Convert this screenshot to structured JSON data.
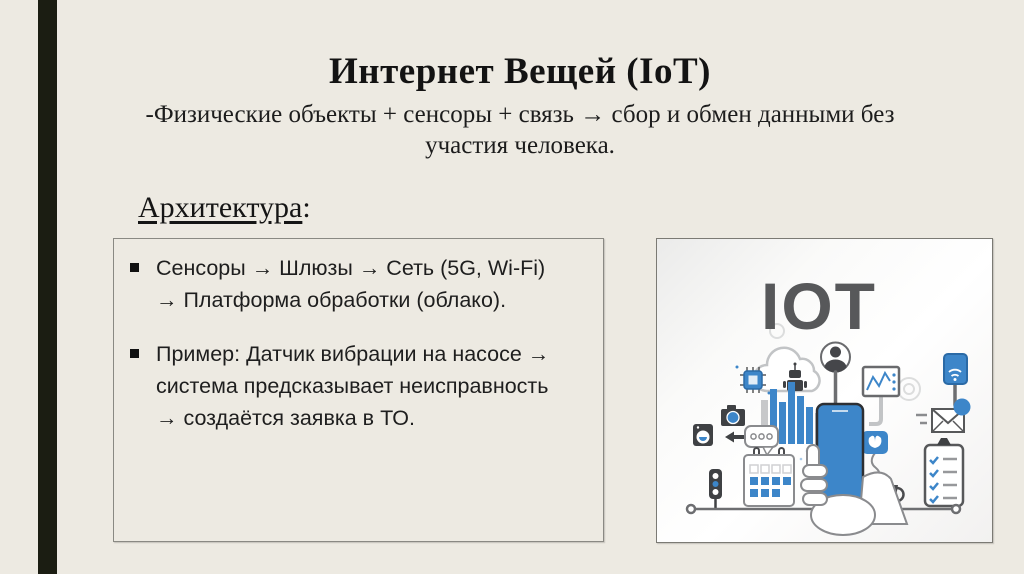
{
  "slide": {
    "title": "Интернет Вещей (IoT)",
    "subtitle_lines": [
      "-Физические объекты + сенсоры + связь → сбор и обмен данными без",
      "участия человека."
    ],
    "section_heading": {
      "word": "Архитектура",
      "colon": ":"
    },
    "bullets": [
      "Сенсоры → Шлюзы → Сеть (5G, Wi-Fi) → Платформа обработки (облако).",
      "Пример: Датчик вибрации на насосе → система предсказывает неисправность → создаётся заявка в ТО."
    ],
    "illustration": {
      "label": "IOT",
      "icons": [
        "chip-icon",
        "cloud-icon",
        "robot-icon",
        "person-avatar-icon",
        "chart-monitor-icon",
        "tablet-wifi-icon",
        "camera-icon",
        "washing-machine-icon",
        "bar-chart-icon",
        "speech-bubble-icon",
        "arrow-left-icon",
        "traffic-light-icon",
        "calendar-icon",
        "hand-phone-icon",
        "plant-icon",
        "coffee-cup-icon",
        "envelope-icon",
        "clipboard-checklist-icon",
        "gear-icon",
        "baseline-icon"
      ]
    },
    "colors": {
      "background": "#EDEAE2",
      "accent_bar": "#1B1D12",
      "text": "#1A1A1A",
      "box_border": "#8A8983",
      "illustration_blue": "#3D86C9",
      "illustration_dark": "#3F4144",
      "illustration_gray": "#6D6E71"
    }
  }
}
